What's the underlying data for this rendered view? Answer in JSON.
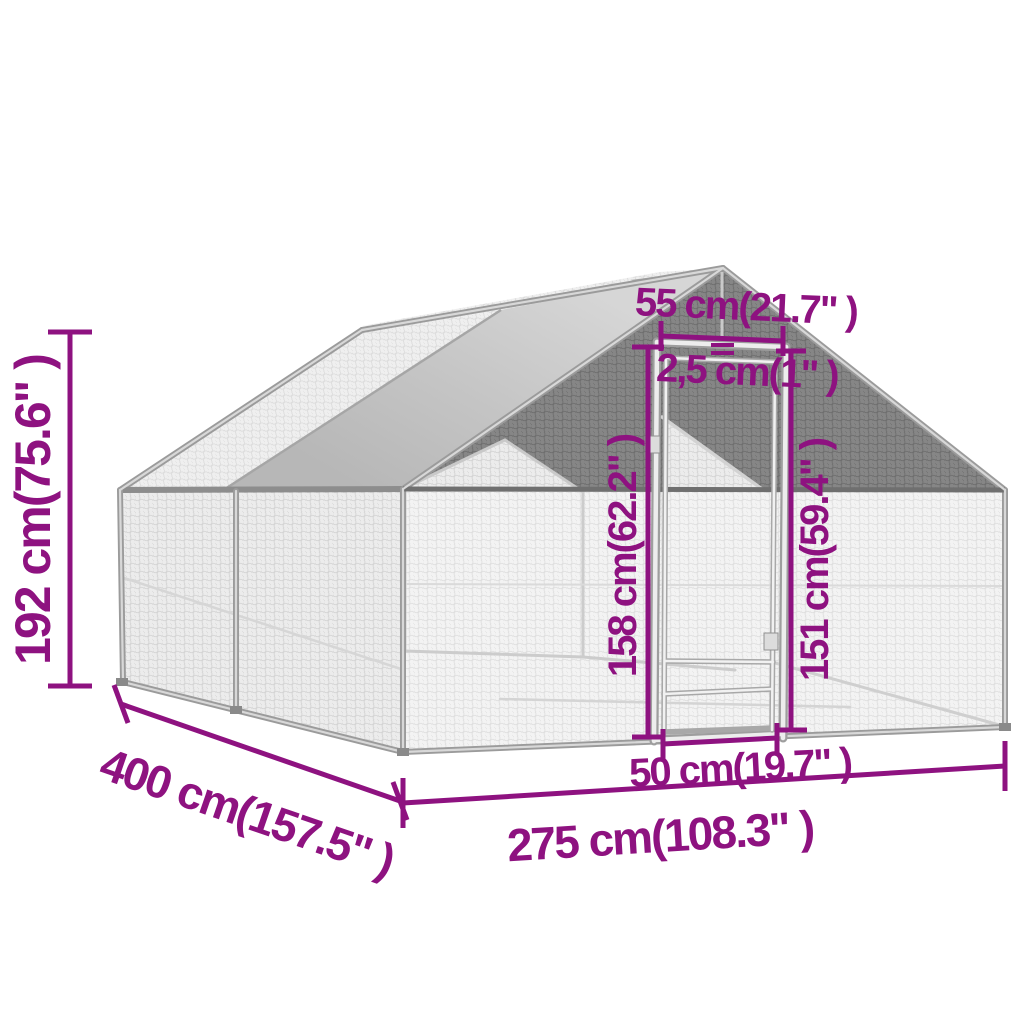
{
  "image": {
    "type": "product-dimension-diagram",
    "subject": "outdoor chicken cage with gable roof, steel mesh walls, roof tarp and front door",
    "background_color": "#ffffff",
    "annotation_color": "#8e1280",
    "structure_colors": {
      "tarp_gray": "#c6c6c6",
      "frame_silver": "#9b9b9b",
      "frame_highlight": "#d8d8d8",
      "mesh_light": "#f3f3f3",
      "mesh_dark": "#858585",
      "eave_dark": "#6f6f6f"
    },
    "dimensions": {
      "overall_height": {
        "label": "192 cm(75.6\" )",
        "cm": 192,
        "inch": 75.6
      },
      "depth": {
        "label": "400 cm(157.5\" )",
        "cm": 400,
        "inch": 157.5
      },
      "width": {
        "label": "275 cm(108.3\" )",
        "cm": 275,
        "inch": 108.3
      },
      "door_top_width": {
        "label": "55 cm(21.7\" )",
        "cm": 55,
        "inch": 21.7
      },
      "tube_diameter": {
        "label": "2,5 cm(1\" )",
        "cm": 2.5,
        "inch": 1
      },
      "door_height": {
        "label": "158 cm(62.2\" )",
        "cm": 158,
        "inch": 62.2
      },
      "door_inner_height": {
        "label": "151 cm(59.4\" )",
        "cm": 151,
        "inch": 59.4
      },
      "door_bottom_width": {
        "label": "50 cm(19.7\" )",
        "cm": 50,
        "inch": 19.7
      }
    }
  }
}
